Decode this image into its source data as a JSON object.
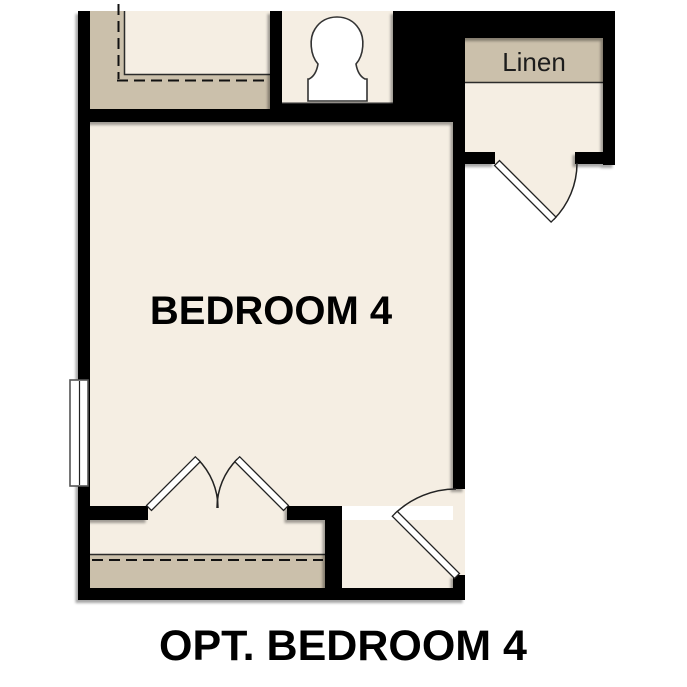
{
  "caption": "OPT. BEDROOM 4",
  "rooms": {
    "bedroom": {
      "label": "BEDROOM 4"
    },
    "linen_closet": {
      "label": "Linen"
    }
  },
  "fixtures": {
    "toilet": "toilet-icon",
    "window": "window-icon",
    "double_door": "double-door-icon",
    "linen_door": "door-swing-icon",
    "entry_door": "door-swing-icon",
    "closet_rod_top": "dashed-closet-rod",
    "closet_rod_bottom": "dashed-closet-rod"
  },
  "colors": {
    "background": "#FFFFFF",
    "floor": "#F5EEE3",
    "shelf": "#CBC0AB",
    "wall": "#000000"
  }
}
